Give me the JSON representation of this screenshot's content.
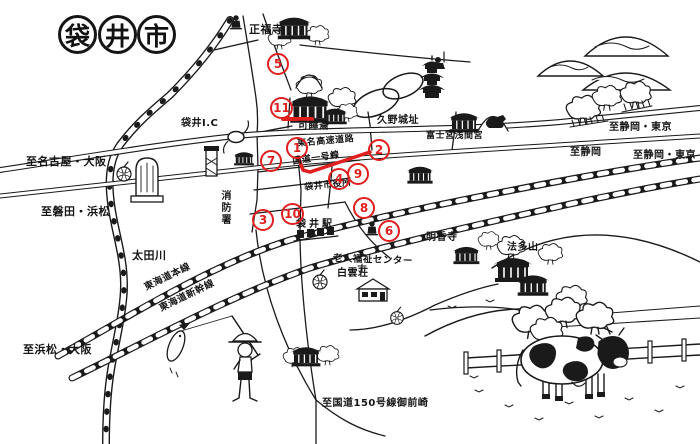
{
  "title": {
    "chars": [
      "袋",
      "井",
      "市"
    ]
  },
  "colors": {
    "ink": "#1a1a1a",
    "marker_red": "#e01f1f",
    "background": "#ffffff"
  },
  "labels": [
    {
      "text": "正福寺"
    },
    {
      "text": "袋井I.C"
    },
    {
      "text": "可睡斎"
    },
    {
      "text": "久野城址"
    },
    {
      "text": "富士宮浅間宮"
    },
    {
      "text": "至静岡・東京"
    },
    {
      "text": "至静岡"
    },
    {
      "text": "至静岡・東京"
    },
    {
      "text": "至名古屋・大阪"
    },
    {
      "text": "至磐田・浜松"
    },
    {
      "text": "消防署"
    },
    {
      "text": "太田川"
    },
    {
      "text": "東名高速道路"
    },
    {
      "text": "国道一号線"
    },
    {
      "text": "袋井市役所"
    },
    {
      "text": "袋井駅"
    },
    {
      "text": "明香寺"
    },
    {
      "text": "法多山"
    },
    {
      "text": "老人福祉センター"
    },
    {
      "text": "白雲荘"
    },
    {
      "text": "東海道本線"
    },
    {
      "text": "東海道新幹線"
    },
    {
      "text": "至浜松・大阪"
    },
    {
      "text": "至国道150号線御前崎"
    }
  ],
  "markers": [
    {
      "n": "1"
    },
    {
      "n": "2"
    },
    {
      "n": "3"
    },
    {
      "n": "4"
    },
    {
      "n": "5"
    },
    {
      "n": "6"
    },
    {
      "n": "7"
    },
    {
      "n": "8"
    },
    {
      "n": "9"
    },
    {
      "n": "10"
    },
    {
      "n": "11"
    }
  ]
}
